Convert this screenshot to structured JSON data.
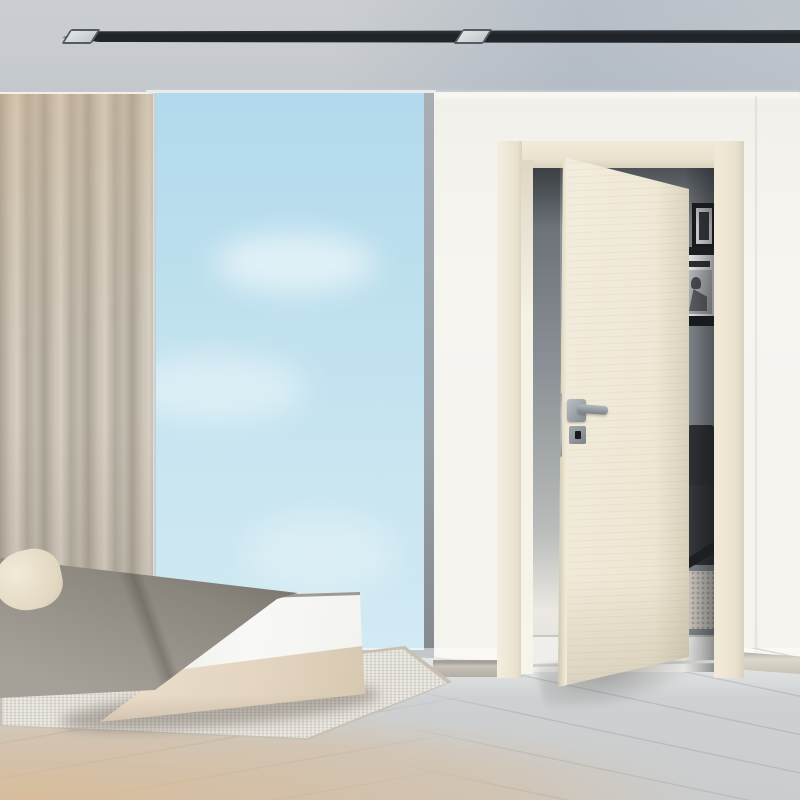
{
  "scene": {
    "type": "interior-photograph",
    "description": "Minimalist bedroom with a floor-to-ceiling window, taupe curtain, low platform bed with a grey throw, pale wood floor, recessed ceiling track lighting, and an ivory interior door standing ajar revealing a hallway with black-framed art, a magazine shelf, a black armchair and a shaggy rug",
    "visible_text": "none",
    "lighting": "soft daylight"
  },
  "palette": {
    "ceiling": "#c9ccd0",
    "ceiling_track": "#23272b",
    "spotlight": "#d8dcde",
    "sky": "#bfe0ee",
    "wall": "#f6f3ee",
    "curtain": "#c2bbae",
    "door_leaf": "#efe9d8",
    "door_frame": "#eae3d0",
    "handle_metal": "#8f979c",
    "hallway_wall": "#8a9095",
    "art_frame": "#17191b",
    "magazine": "#f4f4f2",
    "armchair": "#2b2d30",
    "shag_rug": "#d5cfc7",
    "blanket": "#8f897f",
    "mattress": "#f6f6f4",
    "bed_base": "#e4d6c2",
    "pillow": "#ebe2d0",
    "area_rug": "#dfdbd2",
    "floor_near": "#d8c2a8",
    "floor_far": "#cdd1d4"
  },
  "objects": {
    "ceiling_track_light": "recessed linear track with 2 square spotlights",
    "window": "floor-to-ceiling glazing with clear blue sky",
    "curtain": "full-height taupe drape, left side",
    "bed": "low platform bed: cream pillow, grey throw blanket, white mattress, beige base on woven rug",
    "door": "ivory wood-grain pivot door, ajar, satin lever handle and key escutcheon",
    "hallway_view": "grey wall, black picture frame, shelf with magazine, black leather armchair, white shaggy rug"
  }
}
